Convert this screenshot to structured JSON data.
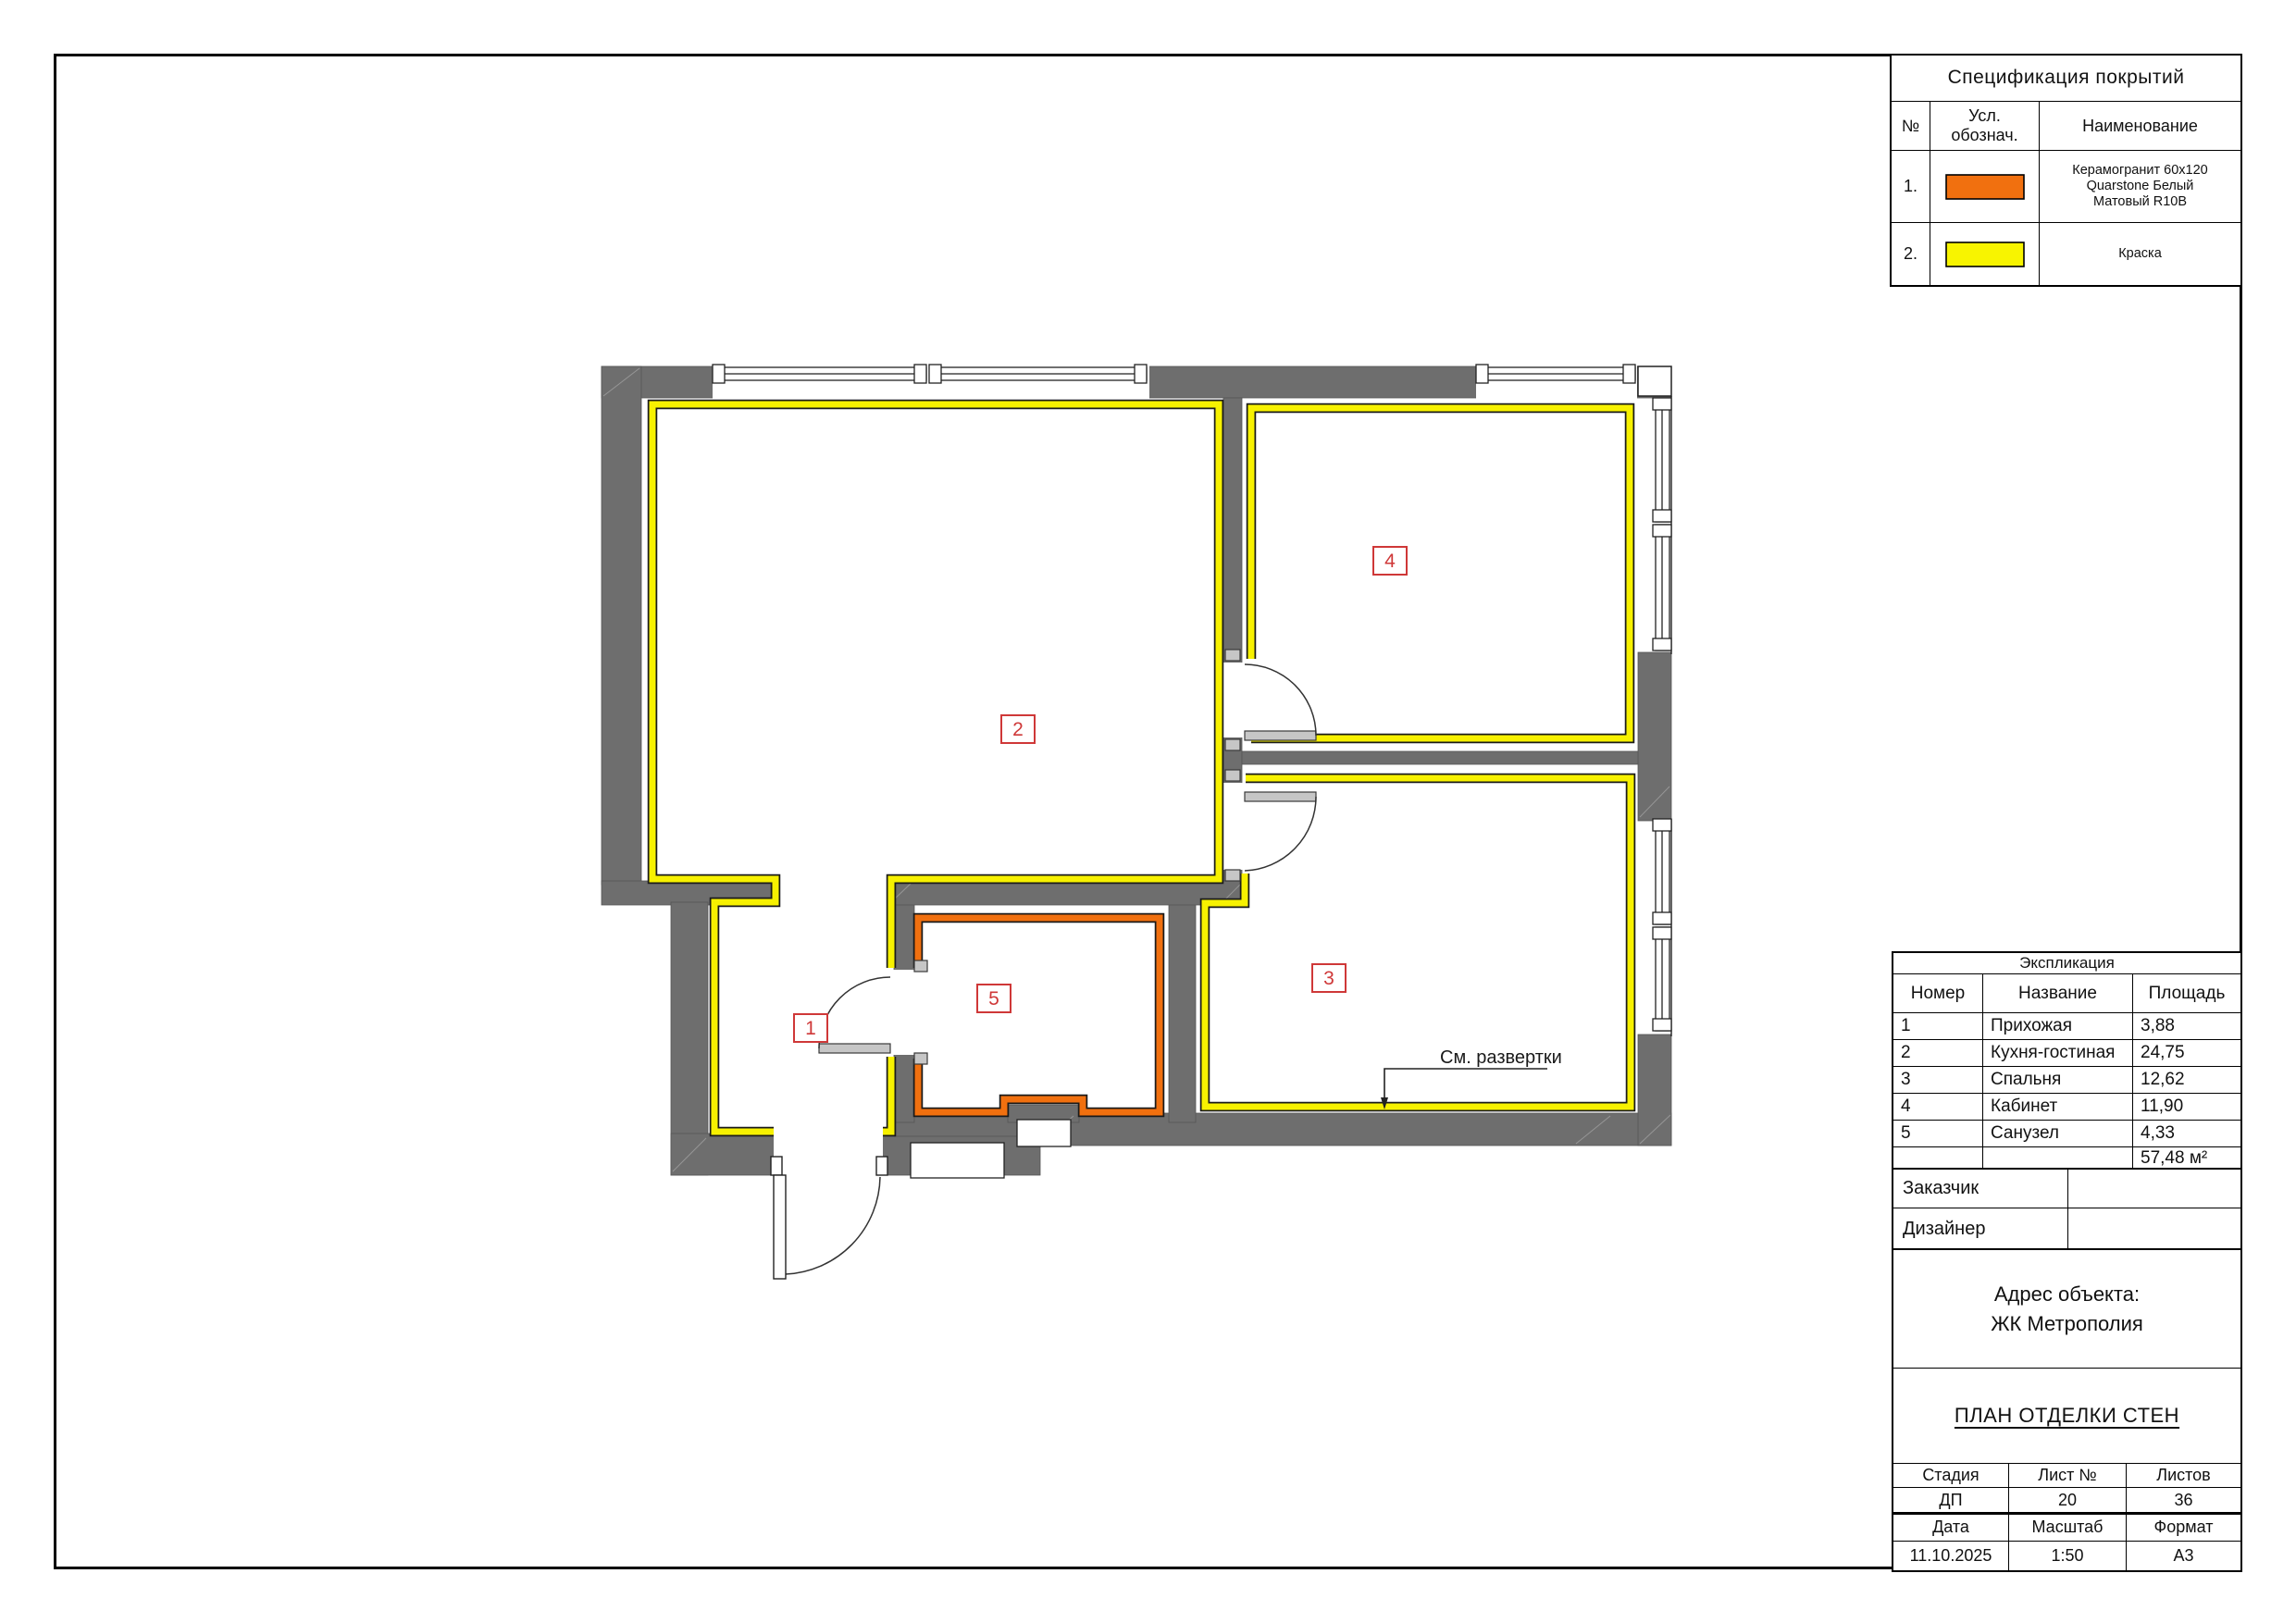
{
  "spec_table": {
    "title": "Спецификация покрытий",
    "col_no": "№",
    "col_symbol_line1": "Усл.",
    "col_symbol_line2": "обознач.",
    "col_name": "Наименование",
    "rows": [
      {
        "no": "1.",
        "color": "#f1700f",
        "name_line1": "Керамогранит 60х120",
        "name_line2": "Quarstone Белый",
        "name_line3": "Матовый R10B"
      },
      {
        "no": "2.",
        "color": "#f8f400",
        "name_line1": "Краска",
        "name_line2": "",
        "name_line3": ""
      }
    ]
  },
  "explication": {
    "title": "Экспликация",
    "col_number": "Номер",
    "col_name": "Название",
    "col_area": "Площадь",
    "rows": [
      {
        "num": "1",
        "name": "Прихожая",
        "area": "3,88"
      },
      {
        "num": "2",
        "name": "Кухня-гостиная",
        "area": "24,75"
      },
      {
        "num": "3",
        "name": "Спальня",
        "area": "12,62"
      },
      {
        "num": "4",
        "name": "Кабинет",
        "area": "11,90"
      },
      {
        "num": "5",
        "name": "Санузел",
        "area": "4,33"
      }
    ],
    "total_area": "57,48 м²"
  },
  "titleblock": {
    "customer_label": "Заказчик",
    "designer_label": "Дизайнер",
    "address_label": "Адрес объекта:",
    "address_value": "ЖК Метрополия",
    "drawing_title": "ПЛАН ОТДЕЛКИ СТЕН",
    "stage_label": "Стадия",
    "sheet_label": "Лист №",
    "sheets_label": "Листов",
    "stage": "ДП",
    "sheet_no": "20",
    "sheets_total": "36",
    "date_label": "Дата",
    "scale_label": "Масштаб",
    "format_label": "Формат",
    "date": "11.10.2025",
    "scale": "1:50",
    "format": "А3"
  },
  "plan": {
    "annotation": "См. развертки",
    "room_tags": [
      {
        "id": "1"
      },
      {
        "id": "2"
      },
      {
        "id": "3"
      },
      {
        "id": "4"
      },
      {
        "id": "5"
      }
    ],
    "colors": {
      "wall": "#6e6e6e",
      "paint_yellow": "#f7f100",
      "tile_orange": "#f1700f",
      "tag_red": "#cf3838"
    }
  }
}
